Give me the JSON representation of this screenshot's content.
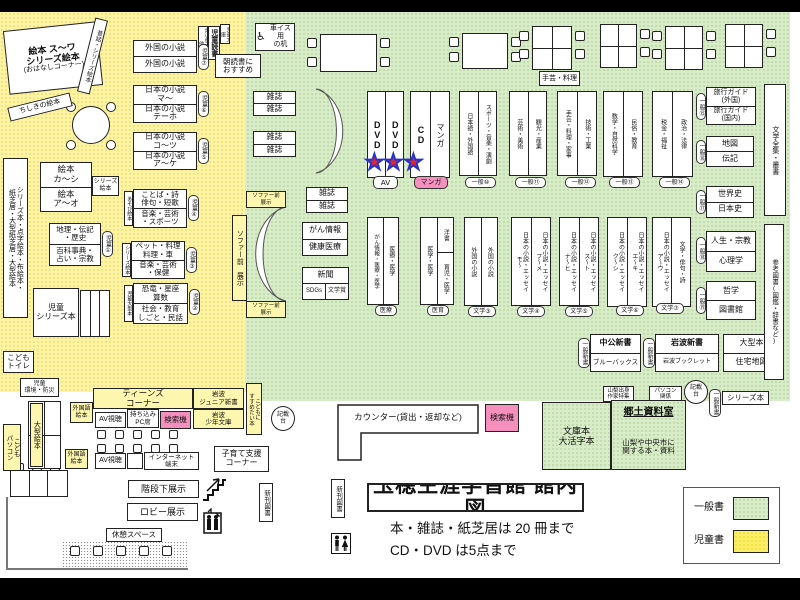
{
  "colors": {
    "children_zone": "#fcf4a4",
    "general_zone": "#d9ecc9",
    "search_machine_pink": "#f590be",
    "star_red": "#e3262a",
    "star_outline_blue": "#2733cf"
  },
  "title_block": {
    "title": "玉穂生涯学習館 館内図",
    "note1": "本・雑誌・紙芝居は 20 冊まで",
    "note2": "CD・DVD は5点まで"
  },
  "legend": {
    "general_label": "一般書",
    "children_label": "児童書"
  },
  "kids": {
    "ohanashi_line1": "絵本 ス〜ワ",
    "ohanashi_line2": "シリーズ絵本",
    "ohanashi_line3": "(おはなしコーナー)",
    "mukashibanashi": "昔話・シリーズ絵本",
    "chishiki": "ちしきの絵本",
    "series_tall": "シリーズ本・点字絵本・布絵本・\n紙芝居・大型紙芝居・大型絵本",
    "shelf7": {
      "top": "外国の小説",
      "bottom": "外国の小説",
      "badge": "児童⑦"
    },
    "shelf6": {
      "top": "日本の小説\nマ〜",
      "bottom": "日本の小説\nテーホ",
      "badge": "児童⑥"
    },
    "shelf5": {
      "top": "日本の小説\nコ〜ツ",
      "bottom": "日本の小説\nア〜ケ",
      "badge": "児童⑤"
    },
    "shelf4": {
      "top": "ことば・詩\n俳句・短歌",
      "bottom": "音楽・芸術\n・スポーツ",
      "badge": "児童④",
      "side": "あそび絵本"
    },
    "shelf3": {
      "top": "ペット・料理\n料理・車",
      "bottom": "音楽・芸術\n・保健",
      "badge": "児童③",
      "side": "シリーズ絵本"
    },
    "shelf2": {
      "top": "恐竜・星座\n算数",
      "bottom": "社会・教育\nしごと・民話",
      "badge": "児童②",
      "side": "児童大型本"
    },
    "shelf1": {
      "top": "地理・伝記\n・歴史",
      "bottom": "百科事典・\n占い・宗教",
      "badge": "児童①"
    },
    "ehon": {
      "top": "絵本\nカ〜シ",
      "bottom": "絵本\nア〜オ",
      "tag": "シリーズ\n絵本"
    },
    "jido_series": "児童\nシリーズ本",
    "dokusho_strips": {
      "left": "青い鳥文庫・他",
      "center": "児童読書",
      "right": "児童文庫"
    },
    "asadoku": "朝読書に\nおすすめ",
    "toilet": "こども\nトイレ",
    "kankyo": "児童\n環境・防災",
    "ogata_ehon": "大型絵本",
    "kodomo_pc": "こども\nパソコン"
  },
  "teens": {
    "header": "ティーンズ\nコーナー",
    "gaikokugo1": "外国語\n絵本",
    "av1": "AV視聴",
    "pc_seat": "持ち込み\nPC席",
    "search1": "検索機",
    "iwanami_junior": "岩波\nジュニア新書",
    "iwanami_shonen": "岩波\n少年文庫",
    "susumetai": "こどもに\nすすめたい本",
    "gaikokugo2": "外国語\n絵本",
    "av2": "AV視聴",
    "internet": "インターネット\n端末",
    "kosodate": "子育て支援\nコーナー"
  },
  "general": {
    "wheelchair_desk": "車イス用\nの机",
    "shugei_ryori_table": "手芸・料理",
    "zasshi": "雑誌",
    "sofa_label": "ソファー前\n展示",
    "sofa_label_v": "ソファー前 展示",
    "dvd": "DVD",
    "cd": "CD",
    "manga": "マンガ",
    "av_badge": "AV",
    "manga_badge": "マンガ",
    "stars_av": "★★",
    "star_manga": "★",
    "stacks": [
      {
        "left": "日本語・外国語",
        "right": "スポーツ・音楽・演劇",
        "badge": "一般⑩"
      },
      {
        "left": "芸術・美術",
        "right": "観光・産業",
        "badge": "一般⑪"
      },
      {
        "left": "手芸・料理・家事",
        "right": "技術・工業",
        "badge": "一般⑫"
      },
      {
        "left": "数学・自然科学",
        "right": "民俗・教育",
        "badge": "一般⑬"
      },
      {
        "left": "税金・福祉",
        "right": "政治・法律",
        "badge": "一般⑭"
      }
    ],
    "side_shelves": [
      {
        "top": "旅行ガイド\n(外国)",
        "bottom": "旅行ガイド\n(国内)",
        "badge": "一般⑮"
      },
      {
        "top": "地図",
        "bottom": "伝記",
        "badge": "一般⑯"
      },
      {
        "top": "世界史",
        "bottom": "日本史",
        "badge": "一般⑰"
      },
      {
        "top": "人生・宗教",
        "bottom": "心理学",
        "badge": "一般⑱"
      },
      {
        "top": "哲学",
        "bottom": "図書館",
        "badge": "一般⑲"
      }
    ],
    "bungaku_zenshu": "文学全集・叢書",
    "sanko_tosho": "参考図書(図鑑・辞書など)",
    "gan_box": {
      "top": "がん情報",
      "bottom": "健康医療"
    },
    "shinbun_box": {
      "top": "新聞",
      "bottom_left": "SDGs",
      "bottom_right": "文学賞"
    },
    "med_stack1": {
      "left": "がん情報・医療・医学",
      "right": "医療・医学",
      "badge": "医療"
    },
    "med_stack2": {
      "left": "医学・医学",
      "right_top": "洋書",
      "right_bottom": "育児・医学",
      "badge": "医育"
    },
    "lit_stacks": [
      {
        "left": "外国の小説",
        "right": "外国の小説",
        "badge": "文学③"
      },
      {
        "left": "日本の小説・エッセイ\nモ〜",
        "right": "日本の小説・エッセイ\nフ〜メ",
        "badge": "文学④"
      },
      {
        "left": "日本の小説・エッセイ\nナ〜ヒ",
        "right": "日本の小説・エッセイ\nス〜ト",
        "badge": "文学⑤"
      },
      {
        "left": "日本の小説・エッセイ\nク〜シ",
        "right": "日本の小説・エッセイ\nエ〜キ",
        "badge": "文学⑥"
      },
      {
        "left": "日本の小説・エッセイ\nア〜ウ",
        "right": "文学・俳句・詩",
        "badge": "文学⑦"
      }
    ],
    "chuko": {
      "top": "中公新書",
      "bottom": "ブルーバックス",
      "badge": "一般新書"
    },
    "iwanami": {
      "top": "岩波新書",
      "bottom": "岩波ブックレット",
      "badge": "一般新書"
    },
    "ogata": {
      "top": "大型本",
      "bottom": "住宅地図"
    }
  },
  "bottom": {
    "kisaidai1": "記載\n台",
    "counter": "カウンター(貸出・返却など)",
    "search2": "検索機",
    "bunko": "文庫本\n大活字本",
    "kyodo_title": "郷土資料室",
    "kyodo_desc": "山梨や中央市に\n関する本・資料",
    "yamanashi": "山梨出身\n作家特集",
    "pc_kankei": "パソコン\n関係",
    "kisaidai2": "記載\n台",
    "ippan_shinsho": "一般新書",
    "series_bon": "シリーズ本",
    "shinkan1": "新刊図書",
    "shinkan2": "新刊図書",
    "kaidan": "階段下展示",
    "lobby": "ロビー展示",
    "kyukei": "休憩スペース"
  }
}
